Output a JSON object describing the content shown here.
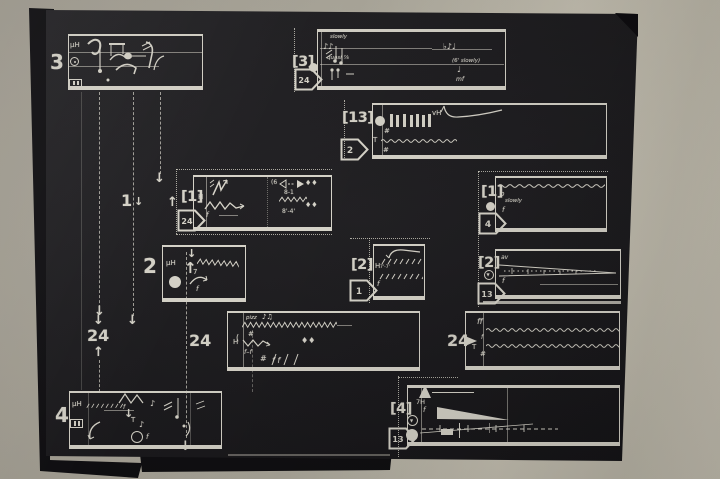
{
  "colors": {
    "background": "#b4afa2",
    "paper": "#1a191c",
    "ink": "#d8d5ca"
  },
  "labels": {
    "s3l": "3",
    "s3m": "[3]",
    "s3m_route": "24",
    "s13": "[13]",
    "s13_route": "2",
    "s1l": "[1]",
    "s1l_route": "24",
    "s1l_pre": "1",
    "s1r": "[1]",
    "s1r_route": "4",
    "s2l": "2",
    "s2m": "[2]",
    "s2m_route": "1",
    "s2r": "[2]",
    "s2r_route": "13",
    "n24_left": "24",
    "n24_mid": "24",
    "n24_right": "24",
    "s4l": "4",
    "s4m": "[4]",
    "s4m_route": "13"
  },
  "glyphs": {
    "down_arrow": "↓",
    "up_arrow": "↑",
    "bold_up": "↑",
    "tri_down": "▼"
  },
  "tokens": {
    "s3l_uH": "μH",
    "s3m_slowly": "slowly",
    "s3m_notes_left": "♪♪",
    "s3m_quasi": "quasi ⅞",
    "s3m_notes_right": "♭♪♩",
    "s3m_slowly2": "(6' slowly)",
    "s3m_note2": "♩",
    "s3m_mf": "mf",
    "s13_vH": "vH",
    "s13_sharp_a": "#",
    "s13_T": "T",
    "s13_sharp_b": "#",
    "s1l_H": "H",
    "s1l_f": "f",
    "s1l_range_a": "8-1",
    "s1l_range_b": "8'-4'",
    "s1l_diam_a": "♦♦",
    "s1l_diam_b": "♦♦",
    "s1l_paren": "(6",
    "s1r_p": "p",
    "s1r_slowly": "slowly",
    "s1r_f": "f",
    "s2l_uH": "μH",
    "s2l_seven": "7",
    "s2l_f": "f",
    "s2m_H": "H",
    "s2m_ticks": "7'-7'",
    "s2m_f": "f",
    "s2r_av": "av",
    "s2r_f": "f",
    "s24m_pizz": "pizz",
    "s24m_notes": "♪♫",
    "s24m_sharp_a": "#",
    "s24m_paren": "(",
    "s24m_H": "H",
    "s24m_ff": "f–f",
    "s24m_diam": "♦♦",
    "s24m_sharp_b": "#",
    "s24m_ff2": "f f",
    "s24r_ff": "ff",
    "s24r_f": "f",
    "s24r_T": "T",
    "s24r_sharp": "#",
    "s4l_uH": "μH",
    "s4l_f_a": "f",
    "s4l_T": "T",
    "s4l_note": "♪",
    "s4l_note2": "♪",
    "s4l_f_b": "f",
    "s4m_vH": "7H",
    "s4m_f": "f"
  }
}
